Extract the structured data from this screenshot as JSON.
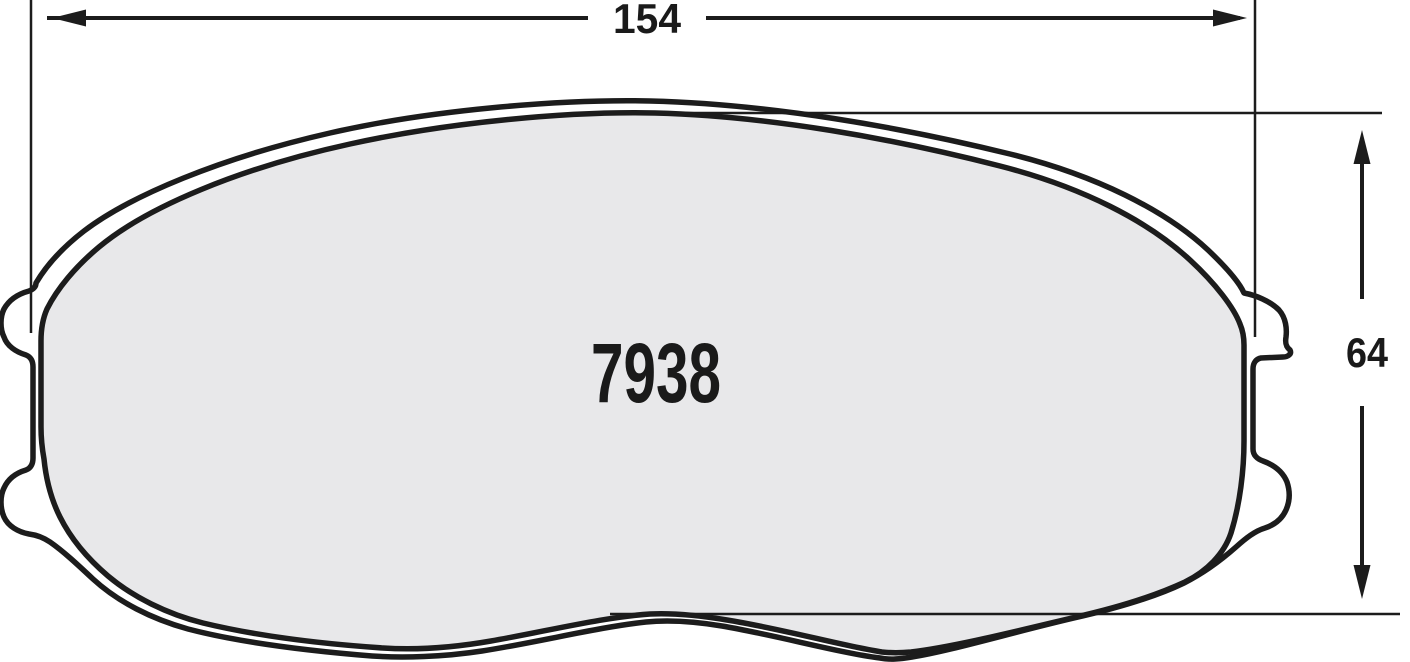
{
  "drawing": {
    "type": "brake-pad-technical-drawing",
    "part_number": "7938",
    "dimensions": {
      "width": {
        "label": "154",
        "orientation": "horizontal"
      },
      "height": {
        "label": "64",
        "orientation": "vertical"
      }
    }
  },
  "colors": {
    "friction_fill": "#e8e8ea",
    "plate_fill": "#ffffff",
    "line": "#1c1c1c",
    "background": "#ffffff"
  }
}
